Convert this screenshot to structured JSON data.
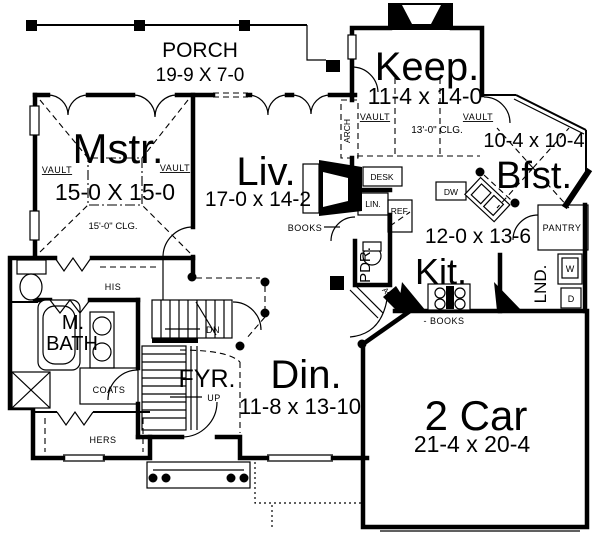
{
  "meta": {
    "ink": "#000000",
    "paper": "#ffffff",
    "drawing_type": "first-floor-plan"
  },
  "rooms": {
    "porch": {
      "name": "PORCH",
      "dims": "19-9 X 7-0"
    },
    "mstr": {
      "name": "Mstr.",
      "dims": "15-0 X 15-0",
      "ceiling": "15'-0\" CLG.",
      "vault_left": "VAULT",
      "vault_right": "VAULT"
    },
    "liv": {
      "name": "Liv.",
      "dims": "17-0 x 14-2"
    },
    "keep": {
      "name": "Keep.",
      "dims": "11-4 x 14-0",
      "ceiling": "13'-0\" CLG.",
      "vault_left": "VAULT",
      "vault_right": "VAULT"
    },
    "bfst": {
      "name": "Bfst.",
      "dims": "10-4 x 10-4"
    },
    "kit": {
      "name": "Kit.",
      "dims": "12-0 x 13-6"
    },
    "din": {
      "name": "Din.",
      "dims": "11-8 x 13-10"
    },
    "garage": {
      "name": "2 Car",
      "dims": "21-4 x 20-4"
    },
    "fyr": {
      "name": "FYR."
    },
    "mbath": {
      "name_line1": "M.",
      "name_line2": "BATH"
    }
  },
  "closets": {
    "his": "HIS",
    "hers": "HERS",
    "coats": "COATS",
    "pantry": "PANTRY",
    "linen": "LIN."
  },
  "fixtures": {
    "powder": "PDR.",
    "laundry": "LND.",
    "refrigerator": "REF.",
    "dishwasher": "DW",
    "washer": "W",
    "dryer": "D",
    "desk": "DESK",
    "books_living": "BOOKS",
    "books_kitchen": "- BOOKS"
  },
  "annotations": {
    "arch_hall": "ARCH",
    "arch_kitchen": "ARCH",
    "stairs_down": "DN",
    "stairs_up": "UP"
  }
}
